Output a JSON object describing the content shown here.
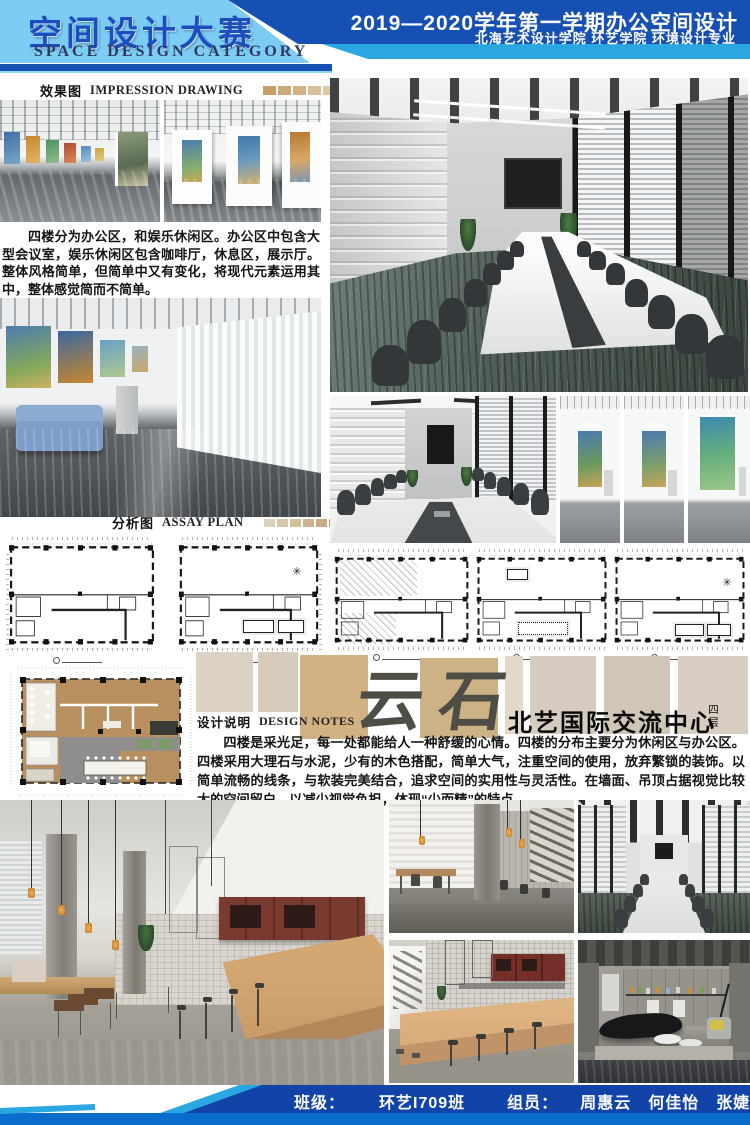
{
  "header": {
    "title_cn": "空间设计大赛",
    "title_en": "SPACE DESIGN CATEGORY",
    "term": "2019—2020学年第一学期办公空间设计",
    "school": "北海艺术设计学院  环艺学院  环境设计专业"
  },
  "sections": {
    "impression": {
      "cn": "效果图",
      "en": "IMPRESSION DRAWING"
    },
    "assay": {
      "cn": "分析图",
      "en": "ASSAY PLAN"
    },
    "notes": {
      "cn": "设计说明",
      "en": "DESIGN NOTES"
    }
  },
  "intro_text": "四楼分为办公区，和娱乐休闲区。办公区中包含大型会议室，娱乐休闲区包含咖啡厅，休息区，展示厅。整体风格简单，但简单中又有变化，将现代元素运用其中，整体感觉简而不简单。",
  "project": {
    "watermark": "云石",
    "title": "北艺国际交流中心",
    "floor": "四层"
  },
  "notes_text": "四楼是采光足，每一处都能给人一种舒缓的心情。四楼的分布主要分为休闲区与办公区。四楼采用大理石与水泥，少有的木色搭配，简单大气，注重空间的使用，放弃繁锁的装饰。以简单流畅的线条，与软装完美结合，追求空间的实用性与灵活性。在墙面、吊顶占据视觉比较大的空间留白，以减少视觉负担，体现“少而精”的特点。",
  "footer": {
    "class_label": "班级：",
    "class_value": "环艺I709班",
    "members_label": "组员：",
    "members": "周惠云　何佳怡　张婕"
  },
  "palettes": {
    "impression": [
      "#c79e66",
      "#cda878",
      "#d2b286",
      "#d9c09a",
      "#dfcaa8",
      "#e4d3b8",
      "#e0d0b4",
      "#eaddc6"
    ],
    "assay": [
      "#ddd0b8",
      "#d8c8aa",
      "#d2bf9c",
      "#ccb58e",
      "#c6ac80",
      "#c0a272",
      "#ba9864",
      "#b48e56"
    ],
    "material": [
      "#dcd2c4",
      "#d7cbbb",
      "#d2b183",
      "#cdb286",
      "#e2d9cb",
      "#d5ccbf",
      "#d0c6b7",
      "#d7cec1"
    ]
  },
  "colors": {
    "header_dark": "#1550b2",
    "header_light": "#7cccf3",
    "accent_cyan": "#2aa7e0",
    "title_blue": "#1b4fc0",
    "footer_blue": "#1243a8",
    "footer_bottom_stripe": "#0b6dcb"
  }
}
